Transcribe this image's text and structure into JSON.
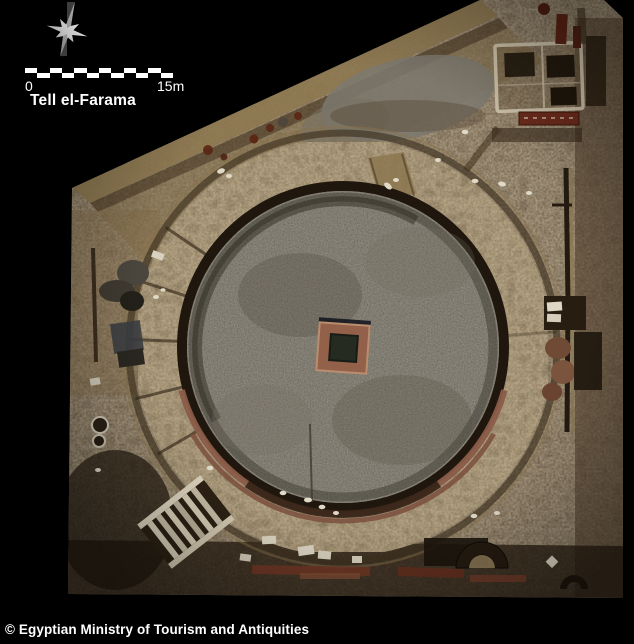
{
  "image": {
    "type": "aerial-orthophoto",
    "subject": "Top-down aerial photograph of an excavated circular ancient theatre ruin with a square central pit, surrounded by mud-brick walls, rooms and rubble at an archaeological dig site",
    "background_color": "#000000"
  },
  "map_overlay": {
    "north_arrow": {
      "icon": "north-star-icon"
    },
    "scale_bar": {
      "start_label": "0",
      "end_label": "15m",
      "segment_count": 12,
      "bar_color_light": "#ffffff",
      "bar_color_dark": "#000000"
    },
    "site_label": "Tell el-Farama",
    "label_color": "#ffffff"
  },
  "credit_line": "© Egyptian Ministry of Tourism and Antiquities"
}
